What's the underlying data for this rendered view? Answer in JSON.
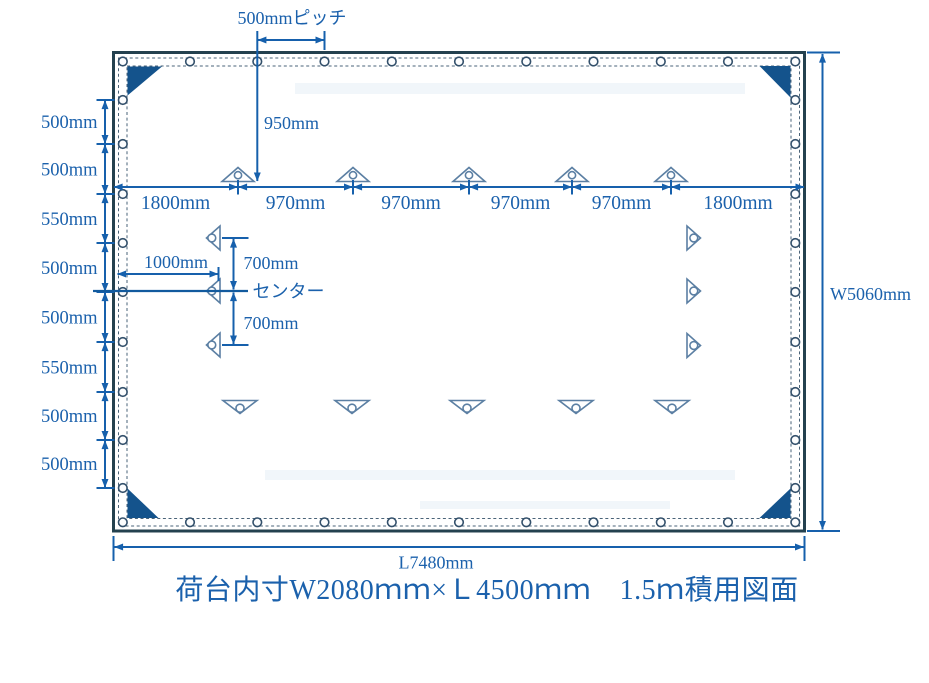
{
  "diagram": {
    "title": "荷台内寸W2080ｍｍ×Ｌ4500ｍｍ　1.5ｍ積用図面",
    "labels": {
      "grommet_pitch": "500mmピッチ",
      "top_drop": "950mm",
      "left_inset": "1000mm",
      "center": "センター",
      "center_offset_upper": "700mm",
      "center_offset_lower": "700mm",
      "overall_width": "W5060mm",
      "overall_length": "L7480mm"
    },
    "top_chain": [
      "1800mm",
      "970mm",
      "970mm",
      "970mm",
      "970mm",
      "1800mm"
    ],
    "left_chain": [
      "500mm",
      "500mm",
      "550mm",
      "500mm",
      "500mm",
      "550mm",
      "500mm",
      "500mm"
    ],
    "colors": {
      "dimension_blue": "#1660ac",
      "edge_navy": "#24414f",
      "corner_fill": "#14538c",
      "loop_outline": "#5b7fa3"
    }
  }
}
